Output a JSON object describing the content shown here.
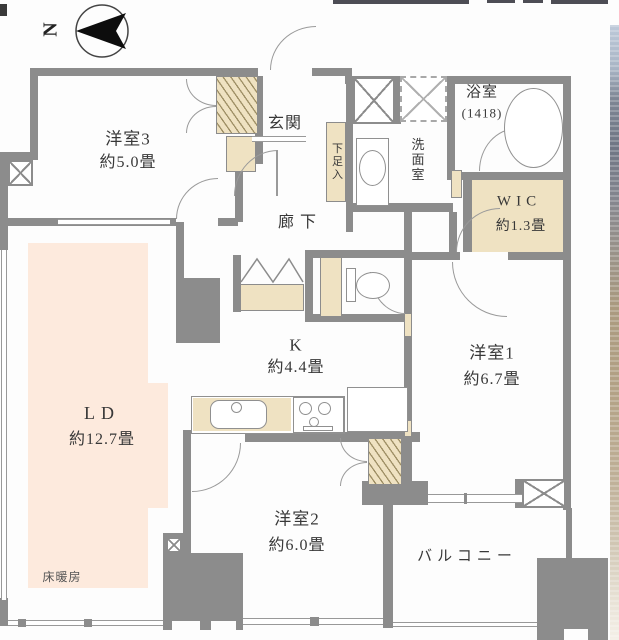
{
  "meta": {
    "type": "apartment-floorplan"
  },
  "compass": {
    "label": "N"
  },
  "labels": {
    "room3": {
      "name": "洋室3",
      "size": "約5.0畳"
    },
    "entrance": {
      "name": "玄関"
    },
    "shoe_box": {
      "name": "下足入"
    },
    "washroom": {
      "name": "洗面室"
    },
    "bathroom": {
      "name": "浴室",
      "size": "(1418)"
    },
    "wic": {
      "name": "WIC",
      "size": "約1.3畳"
    },
    "hallway": {
      "name": "廊下"
    },
    "kitchen": {
      "name": "K",
      "size": "約4.4畳"
    },
    "room1": {
      "name": "洋室1",
      "size": "約6.7畳"
    },
    "living": {
      "name": "LD",
      "size": "約12.7畳",
      "note": "床暖房"
    },
    "room2": {
      "name": "洋室2",
      "size": "約6.0畳"
    },
    "balcony": {
      "name": "バルコニー"
    }
  },
  "colors": {
    "wall": "#8c8c8c",
    "closet_fill": "#efe2c2",
    "floor_heating_fill": "#fdeadd",
    "line": "#999999",
    "text": "#383838"
  }
}
